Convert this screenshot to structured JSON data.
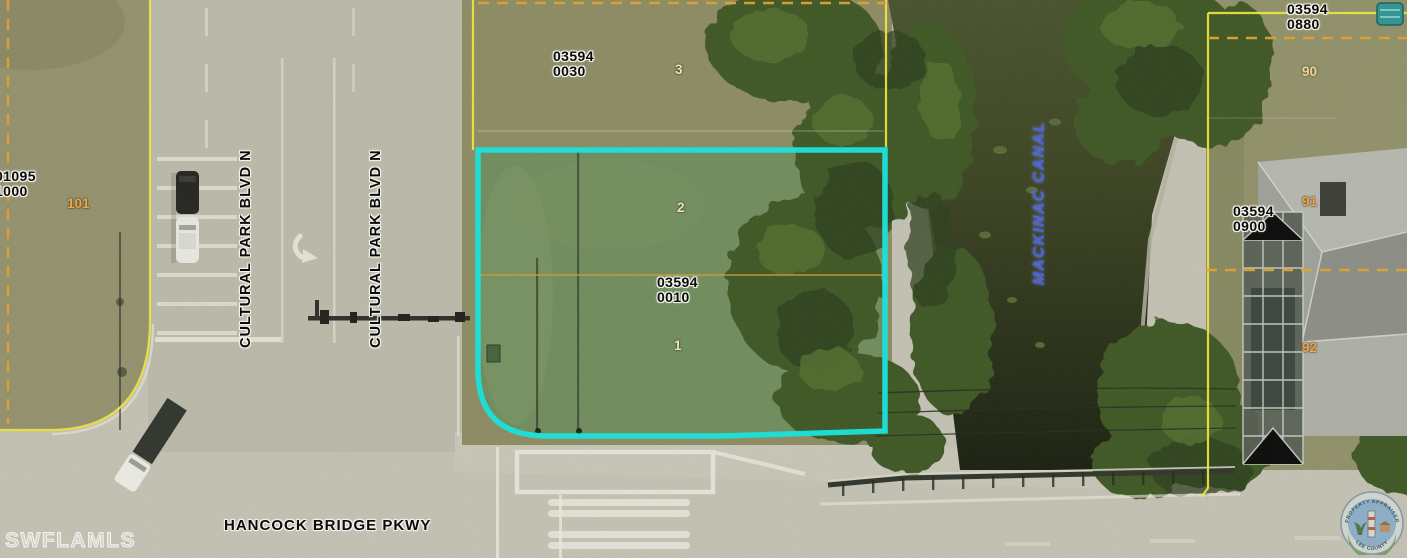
{
  "map_labels": {
    "parcels": {
      "northwest": {
        "book": "01095",
        "page": "1000",
        "lot": "101"
      },
      "north": {
        "book": "03594",
        "page": "0030",
        "lot": "3"
      },
      "subject": {
        "book": "03594",
        "page": "0010",
        "lot_upper": "2",
        "lot_lower": "1"
      },
      "northeast": {
        "book": "03594",
        "page": "0880",
        "lot": "90"
      },
      "east": {
        "book": "03594",
        "page": "0900",
        "lot_upper": "91",
        "lot_lower": "92"
      }
    },
    "streets": {
      "cultural_park_west": "CULTURAL PARK BLVD N",
      "cultural_park_east": "CULTURAL PARK BLVD N",
      "hancock": "HANCOCK BRIDGE PKWY"
    },
    "waterway": "MACKINAC CANAL",
    "watermark": "SWFLAMLS",
    "logo": {
      "arc_top": "PROPERTY APPRAISER",
      "arc_bottom": "LEE COUNTY"
    }
  },
  "colors": {
    "subject_parcel_outline": "#16e2da",
    "parcel_boundary_yellow": "#ece43d",
    "parcel_boundary_orange": "#dfa02c",
    "canal_label_blue": "#4c63d8",
    "lot_number_cream": "#eae3bf",
    "lot_number_orange": "#eaa64d"
  }
}
